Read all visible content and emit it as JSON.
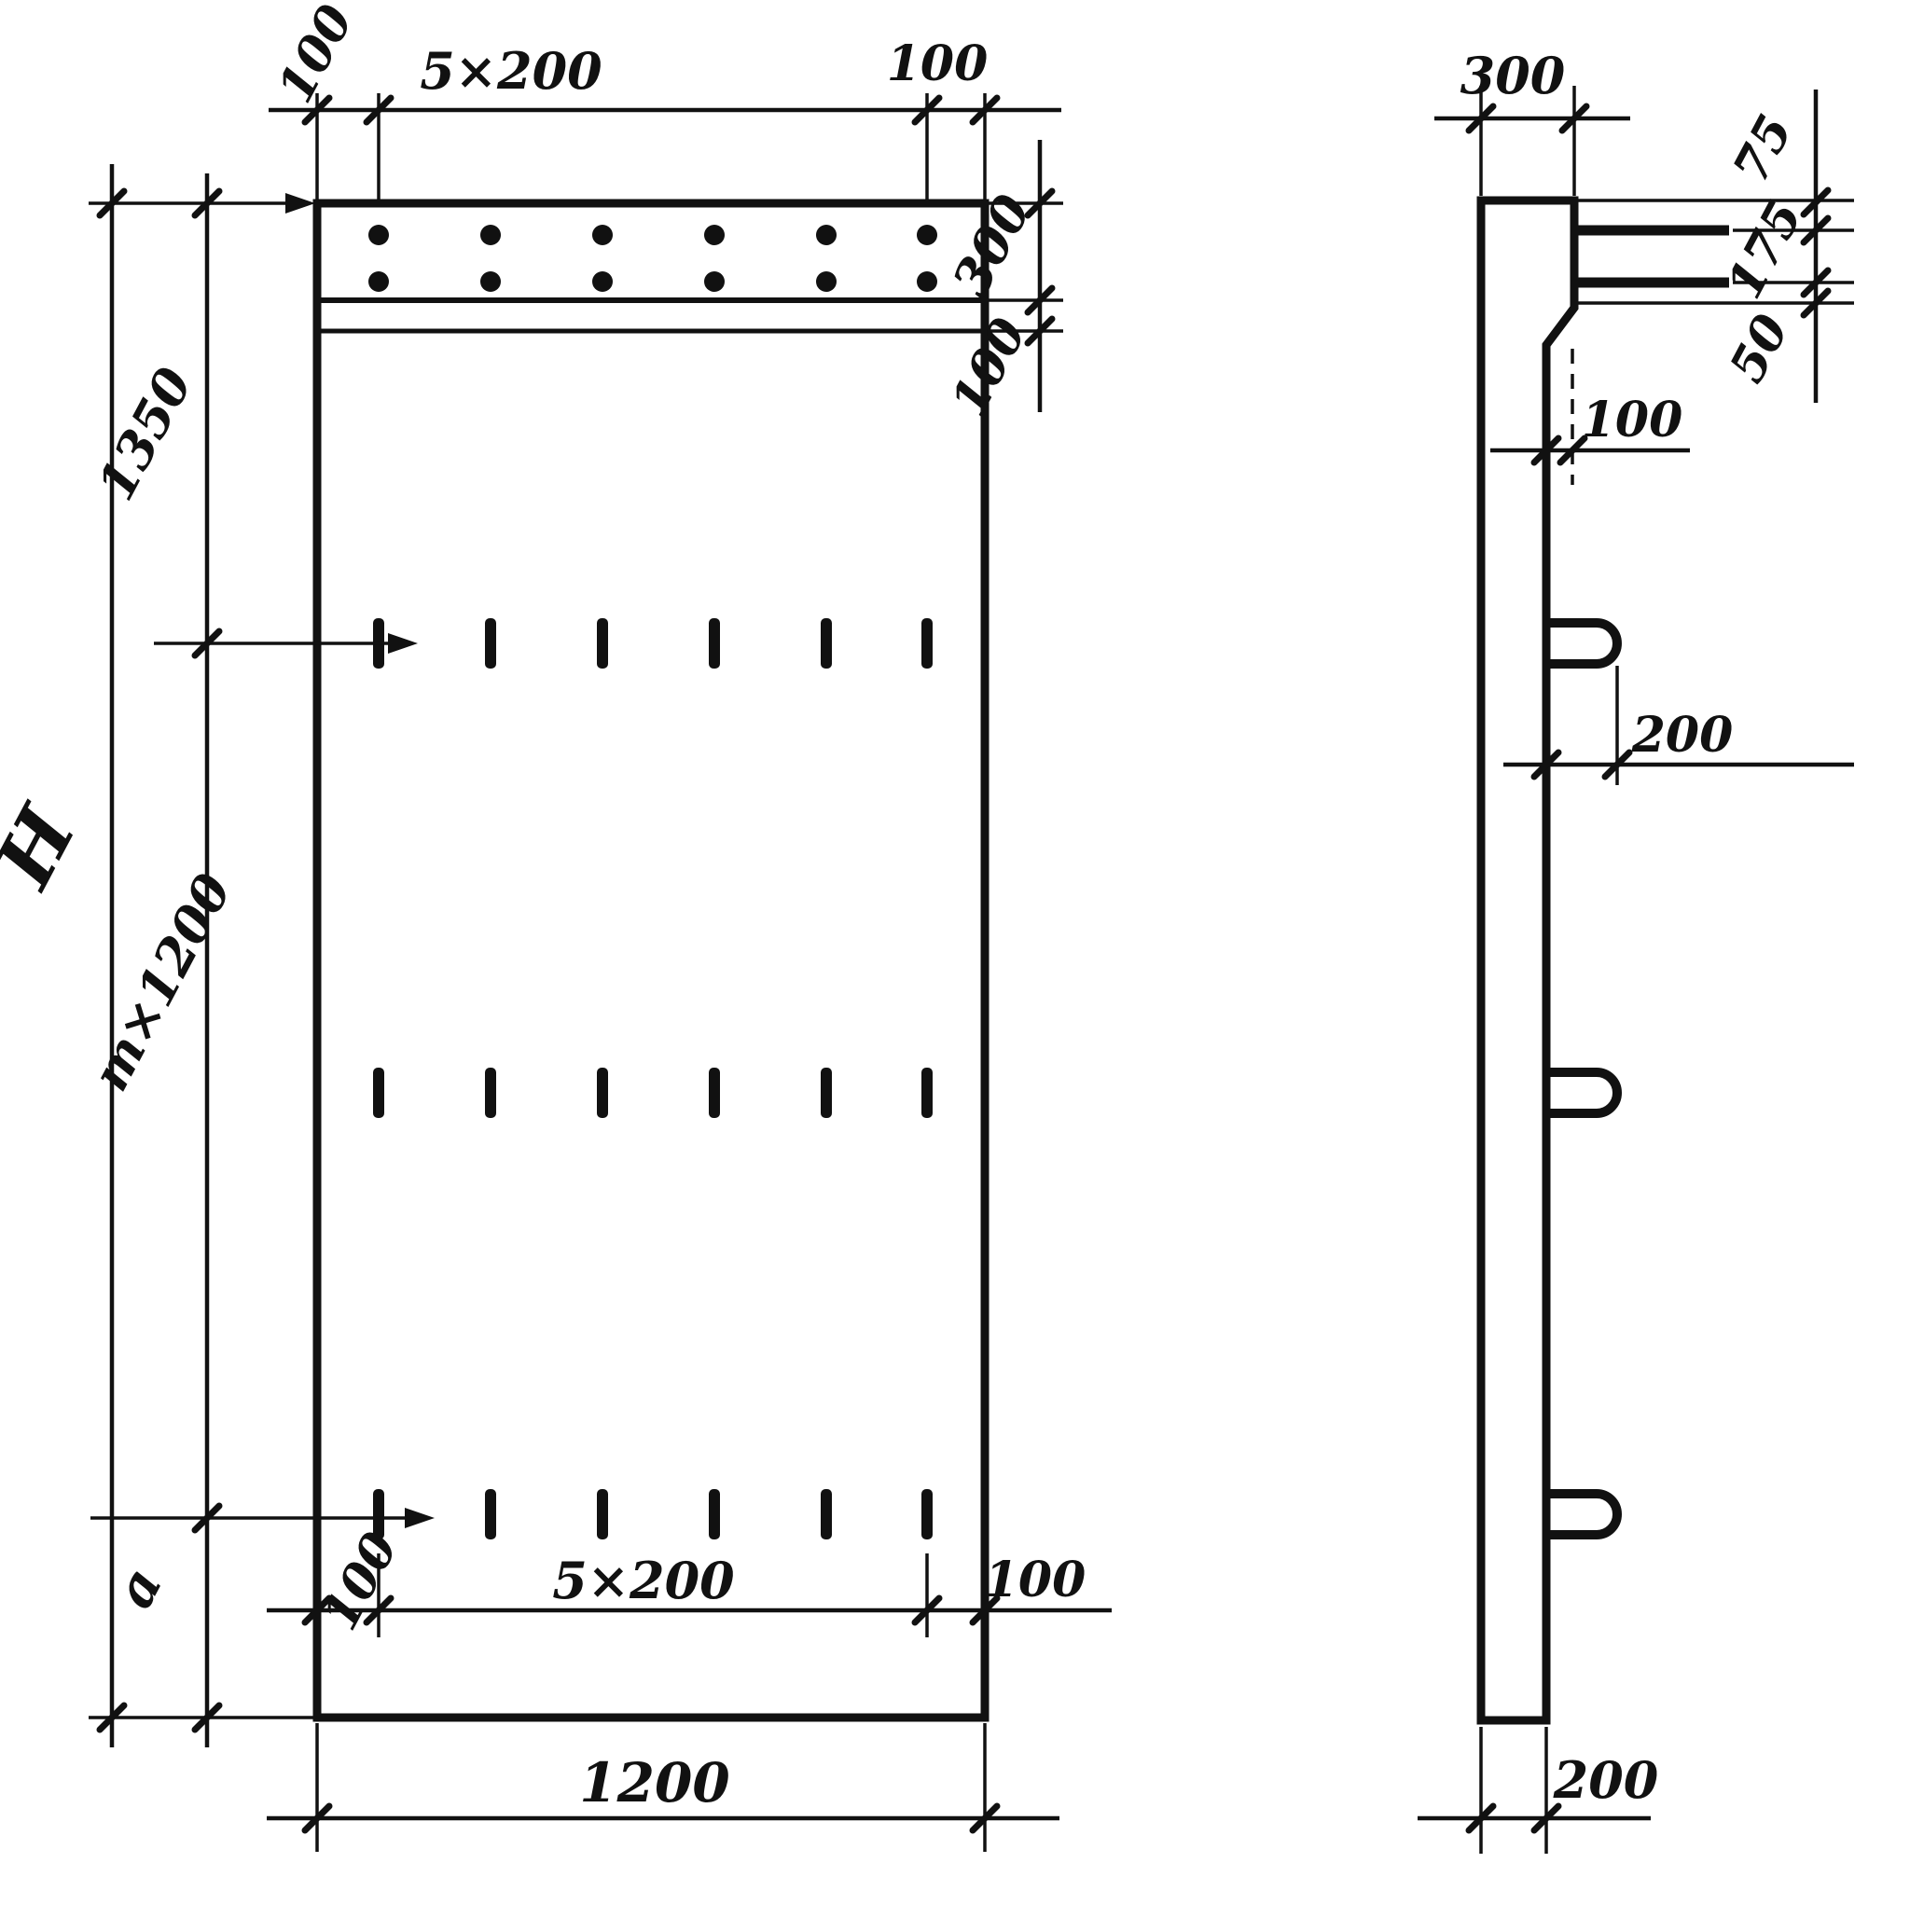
{
  "drawing_title": "reinforced-panel-technical-drawing",
  "colors": {
    "ink": "#111111",
    "paper": "#ffffff"
  },
  "front": {
    "top": {
      "left_offset": "100",
      "pitch": "5×200",
      "right_offset": "100"
    },
    "right": {
      "band_height": "300",
      "strip_height": "100"
    },
    "left": {
      "overall_height": "H",
      "top_segment": "1350",
      "middle_segment": "m×1200",
      "bottom_segment": "a"
    },
    "bottom": {
      "left_offset": "100",
      "pitch": "5×200",
      "right_offset": "100",
      "overall_width": "1200"
    }
  },
  "side": {
    "top_width": "300",
    "right": {
      "seg_top": "75",
      "seg_middle": "175",
      "seg_bottom": "50"
    },
    "ledge_offset": "100",
    "loop_length": "200",
    "panel_thickness": "200"
  }
}
